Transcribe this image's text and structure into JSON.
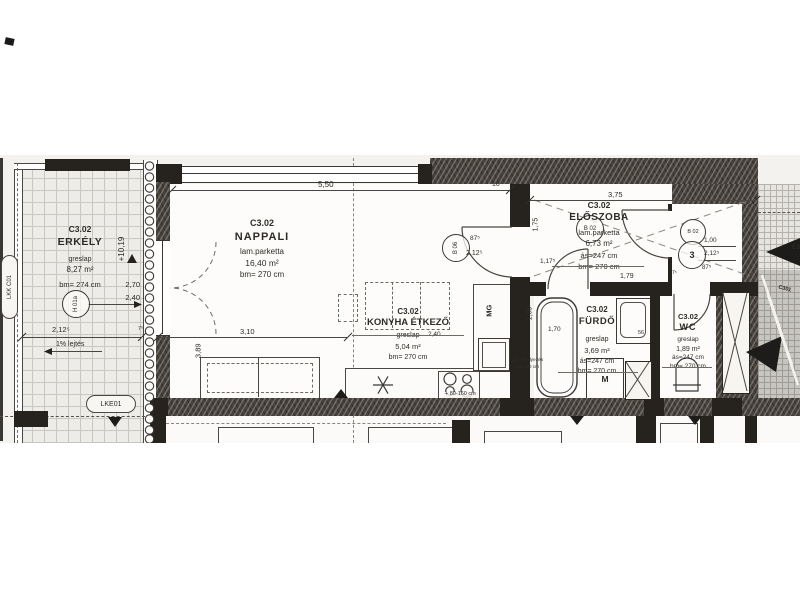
{
  "sheet": {
    "unit": "C3.02",
    "rooms": {
      "erkely": {
        "code": "C3.02",
        "name": "ERKÉLY",
        "floor": "greslap",
        "area": "8,27 m²",
        "bm": "bm= 274 cm"
      },
      "nappali": {
        "code": "C3.02",
        "name": "NAPPALI",
        "floor": "lam.parketta",
        "area": "16,40 m²",
        "bm": "bm= 270 cm"
      },
      "konyha": {
        "code": "C3.02",
        "name": "KONYHA ÉTKEZŐ",
        "floor": "greslap",
        "area": "5,04 m²",
        "bm": "bm= 270 cm"
      },
      "eloszoba": {
        "code": "C3.02",
        "name": "ELŐSZOBA",
        "floor": "lam.parketta",
        "area": "6,73 m²",
        "as_h": "ás=247 cm",
        "bm": "bm= 270 cm",
        "dim": "1,79"
      },
      "furdo": {
        "code": "C3.02",
        "name": "FÜRDŐ",
        "floor": "greslap",
        "area": "3,69 m²",
        "as_h": "ás=247 cm",
        "bm": "bm= 270 cm"
      },
      "wc": {
        "code": "C3.02",
        "name": "WC",
        "floor": "greslap",
        "area": "1,89 m²",
        "as_h": "ás=247 cm",
        "bm": "bm= 270 cm"
      }
    },
    "dims": {
      "top_len": "5,50",
      "top_wall": "10",
      "eloszoba_top": "3,75",
      "nappali_h": "3,89",
      "nappali_w": "3,10",
      "erkely_d1": "2,70",
      "erkely_d2": "2,40",
      "erkely_w": "2,12⁵",
      "erkely_t": "7⁵",
      "elevation": "+10,19",
      "slope": "1% lejtés",
      "door_w": "87⁵",
      "door_h": "2,12⁵",
      "hall_h": "1,75",
      "hall_n": "1,17⁵",
      "entry_a": "1,00",
      "entry_b": "2,12⁵",
      "entry_c": "87⁵",
      "entry_t": "7⁵",
      "bath_w": "1,05",
      "bath_l": "1,70",
      "basin_w": "56",
      "kitchen_dim": "2,40",
      "range_note": "+ 80-160 cm"
    },
    "tags": {
      "balcony_door": "H 01a",
      "living_door": "B 06",
      "hall_door_a": "B 02",
      "hall_door_b": "B 02",
      "entry_no": "3",
      "dishwasher": "MG",
      "washing_machine": "M",
      "balcony_code": "LKK C01",
      "balcony_code2": "LKE01",
      "section_a": "C301",
      "section_b": "C301"
    },
    "notes": {
      "gk_line1": "gk. elhelyezés",
      "gk_line2": "pv= 80 cm"
    }
  }
}
